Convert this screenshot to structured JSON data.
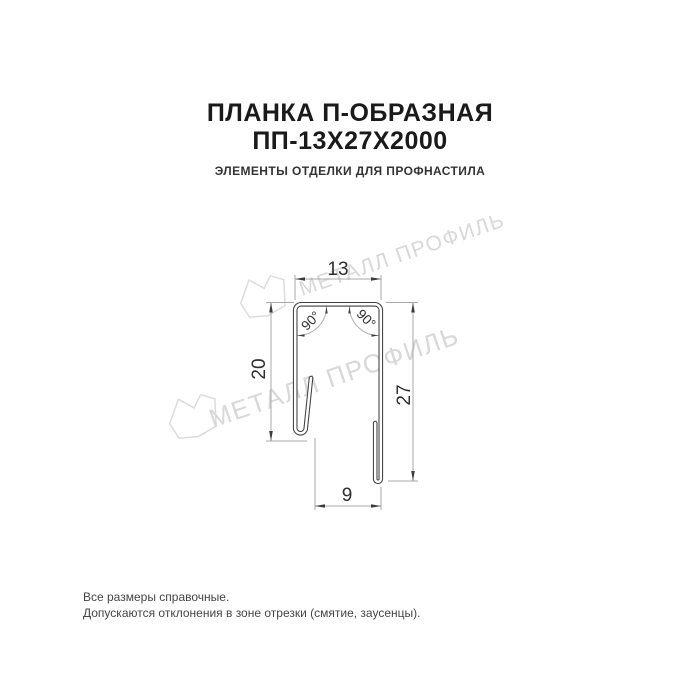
{
  "header": {
    "title_line1": "ПЛАНКА П-ОБРАЗНАЯ",
    "title_line2": "ПП-13Х27Х2000",
    "subtitle": "ЭЛЕМЕНТЫ ОТДЕЛКИ ДЛЯ ПРОФНАСТИЛА"
  },
  "drawing": {
    "type": "profile-cross-section",
    "dimensions": {
      "top_width_mm": "13",
      "left_height_mm": "20",
      "right_height_mm": "27",
      "bottom_width_mm": "9",
      "angle_left": "90°",
      "angle_right": "90°"
    }
  },
  "watermarks": {
    "text": "МЕТАЛЛ ПРОФИЛЬ",
    "color": "#d8d8d8"
  },
  "footer": {
    "line1": "Все размеры справочные.",
    "line2": "Допускаются отклонения в зоне отрезки (смятие, заусенцы)."
  },
  "colors": {
    "profile_line": "#3f3f3f",
    "dimension_line": "#a8a8a8",
    "dimension_text": "#2e2e2e",
    "title_text": "#1a1a1a",
    "footer_text": "#454545",
    "background": "#ffffff"
  }
}
